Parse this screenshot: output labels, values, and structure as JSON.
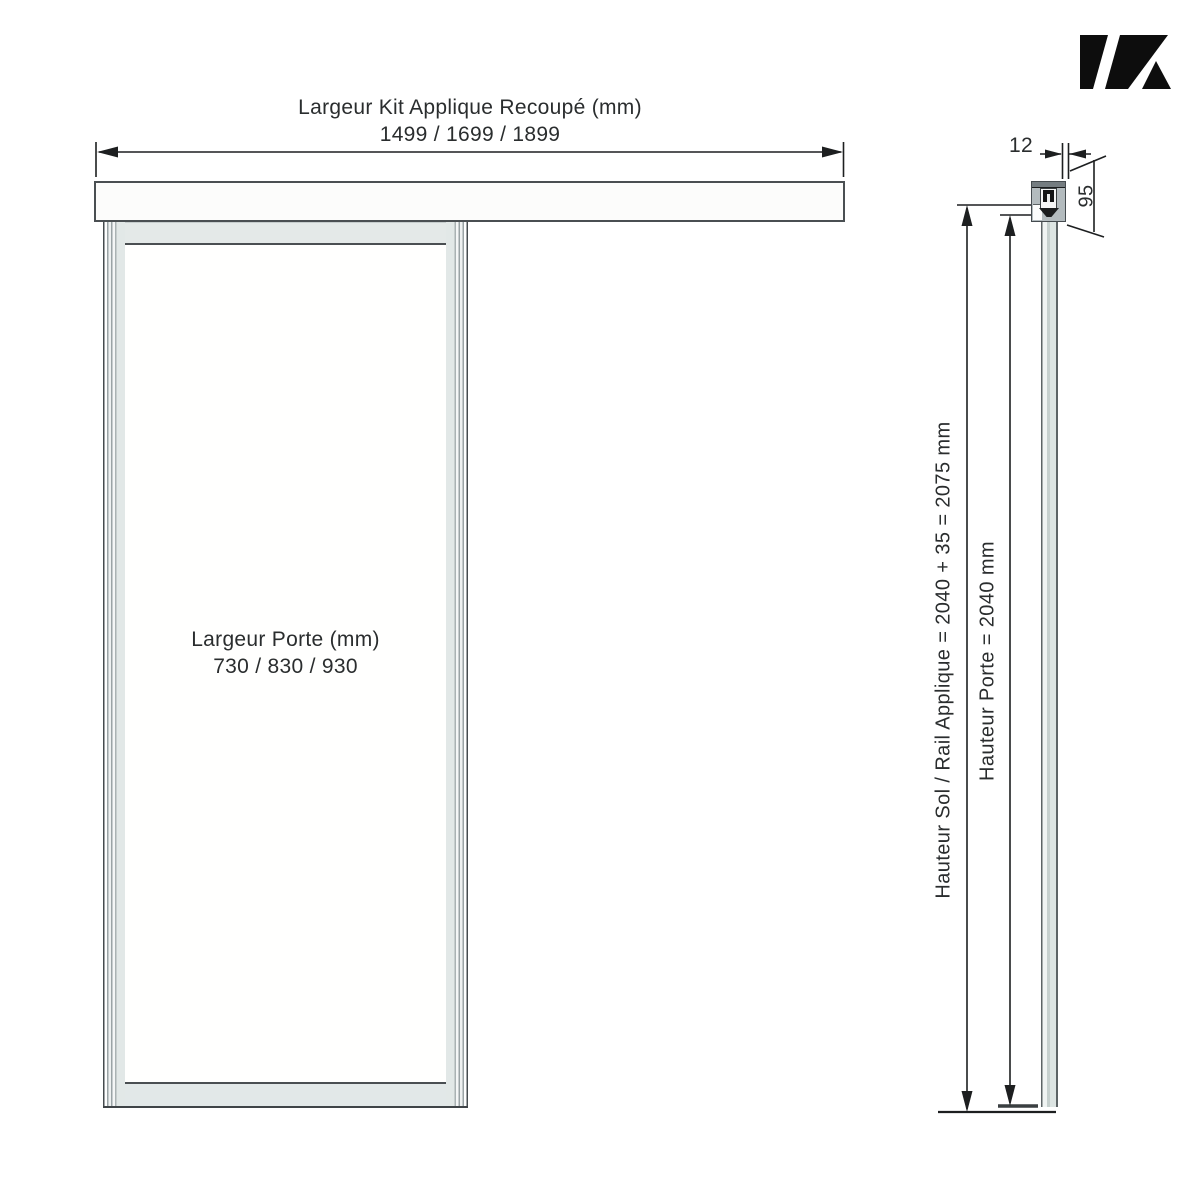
{
  "front_view": {
    "kit_width": {
      "label": "Largeur Kit Applique Recoupé (mm)",
      "values": "1499 / 1699 / 1899"
    },
    "door_width": {
      "label": "Largeur Porte (mm)",
      "values": "730 / 830 / 930"
    }
  },
  "side_view": {
    "total_height_label": "Hauteur Sol / Rail Applique = 2040 + 35 = 2075 mm",
    "door_height_label": "Hauteur Porte = 2040 mm",
    "door_thickness_value": "12",
    "rail_profile_height_value": "95"
  },
  "icons": {
    "brand_logo": "k-mark-logo"
  },
  "colors": {
    "line": "#1d1f20",
    "panel_band": "#e4e9e8",
    "track_fill": "#b3bbbe",
    "logo": "#0d0d0d",
    "background": "#ffffff"
  }
}
